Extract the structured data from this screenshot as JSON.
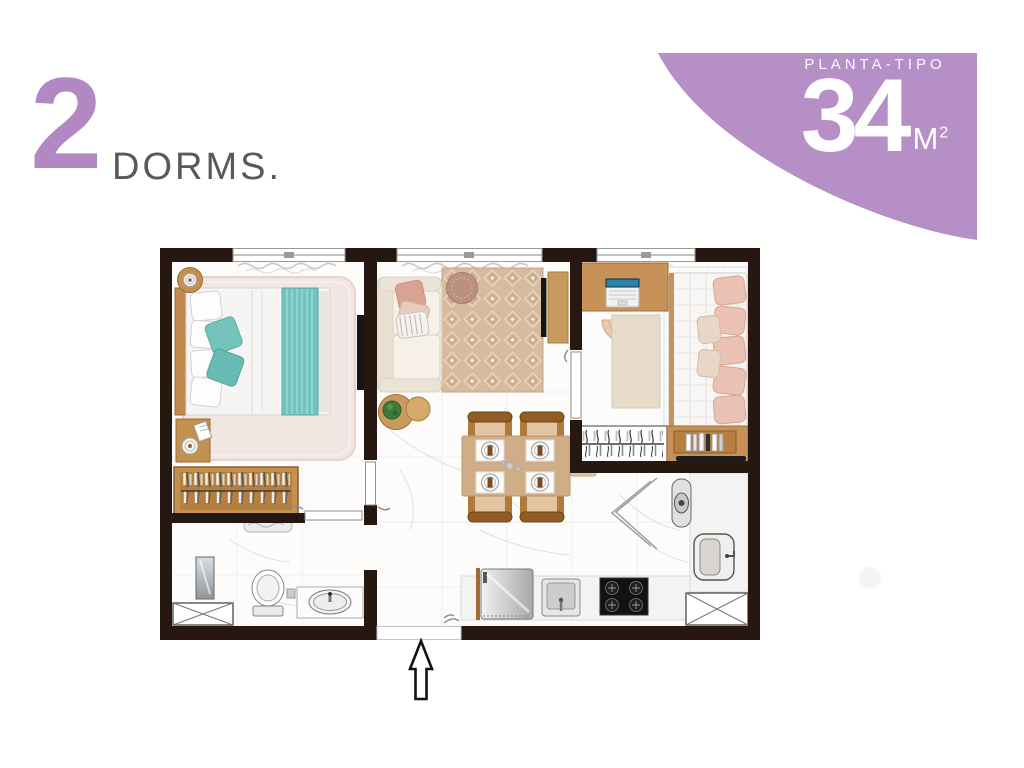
{
  "header": {
    "dorm_count": "2",
    "dorm_label": "DORMS."
  },
  "badge": {
    "eyebrow": "PLANTA-TIPO",
    "area_value": "34",
    "area_unit": "M",
    "area_unit_exp": "2"
  },
  "colors": {
    "accent_purple": "#b287c2",
    "badge_purple": "#b78fc7",
    "wall_dark": "#261811",
    "wood": "#c08a4f",
    "teal": "#6fc3bc",
    "blush": "#eac2b4",
    "rug_beige": "#d8bb9e",
    "text_gray": "#59595c"
  },
  "plan": {
    "type": "apartment-floor-plan",
    "windows": 3,
    "entrance_marker": "arrow-up",
    "rooms": [
      {
        "name": "bedroom-1",
        "furniture": [
          "double-bed",
          "headboard",
          "teal-runner",
          "teal-pillows",
          "fluffy-rug",
          "round-side-table",
          "nightstand",
          "lamps",
          "open-wardrobe-rack",
          "wall-tv"
        ]
      },
      {
        "name": "living-room",
        "furniture": [
          "sofa",
          "patterned-rug",
          "pouf",
          "coffee-tables",
          "plant",
          "tv-console",
          "tv"
        ]
      },
      {
        "name": "dining-area",
        "furniture": [
          "dining-table",
          "side-bench",
          "four-chairs",
          "placemats"
        ]
      },
      {
        "name": "bedroom-2",
        "furniture": [
          "desk",
          "laptop",
          "desk-chair",
          "rug",
          "single-bed",
          "pink-pillows",
          "wardrobe-rack",
          "bookshelf"
        ]
      },
      {
        "name": "bathroom",
        "furniture": [
          "shower-glass",
          "towel",
          "toilet",
          "vanity-sink",
          "duct-shaft"
        ]
      },
      {
        "name": "kitchen-laundry",
        "furniture": [
          "fridge",
          "kitchen-sink",
          "cooktop",
          "counter",
          "water-heater",
          "laundry-tank",
          "folding-doors",
          "duct-shaft"
        ]
      }
    ]
  }
}
